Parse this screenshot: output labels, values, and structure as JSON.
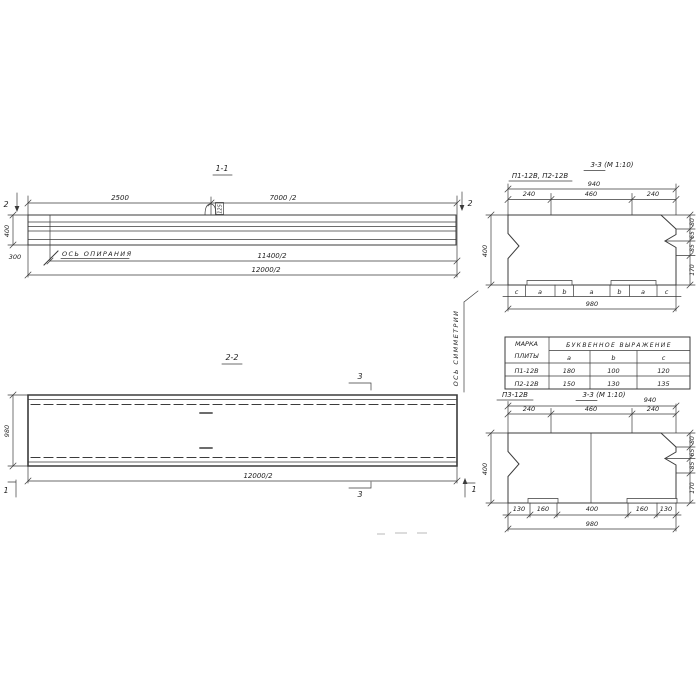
{
  "elev": {
    "title": "1-1",
    "dim_2500": "2500",
    "dim_7000": "7000 /2",
    "cut2": "2",
    "dim_400": "400",
    "dim_300": "300",
    "support_axis_label": "ОСЬ ОПИРАНИЯ",
    "dim_11400": "11400/2",
    "dim_12000": "12000/2",
    "loop_label": "125"
  },
  "plan": {
    "title": "2-2",
    "cut3": "3",
    "cut1": "1",
    "dim_980": "980",
    "dim_12000": "12000/2",
    "symmetry_axis_label": "ОСЬ СИММЕТРИИ"
  },
  "sec_top": {
    "label": "П1-12В, П2-12В",
    "title": "3-3 (М 1:10)",
    "dim_940": "940",
    "dim_240": "240",
    "dim_460": "460",
    "dim_400": "400",
    "dim_80": "80",
    "dim_65": "65",
    "dim_85": "85",
    "dim_170": "170",
    "letters": [
      "c",
      "a",
      "b",
      "a",
      "b",
      "a",
      "c"
    ],
    "dim_980": "980"
  },
  "table": {
    "col1_line1": "МАРКА",
    "col1_line2": "ПЛИТЫ",
    "span_header": "БУКВЕННОЕ ВЫРАЖЕНИЕ",
    "col_a": "a",
    "col_b": "b",
    "col_c": "c",
    "rows": [
      {
        "mark": "П1-12В",
        "a": "180",
        "b": "100",
        "c": "120"
      },
      {
        "mark": "П2-12В",
        "a": "150",
        "b": "130",
        "c": "135"
      }
    ]
  },
  "sec_bottom": {
    "label": "П3-12В",
    "title": "3-3 (М 1:10)",
    "dim_940": "940",
    "dim_240": "240",
    "dim_460": "460",
    "dim_400": "400",
    "dim_80": "80",
    "dim_65": "65",
    "dim_85": "85",
    "dim_170": "170",
    "dims_bottom": [
      "130",
      "160",
      "400",
      "160",
      "130"
    ],
    "dim_980": "980"
  }
}
